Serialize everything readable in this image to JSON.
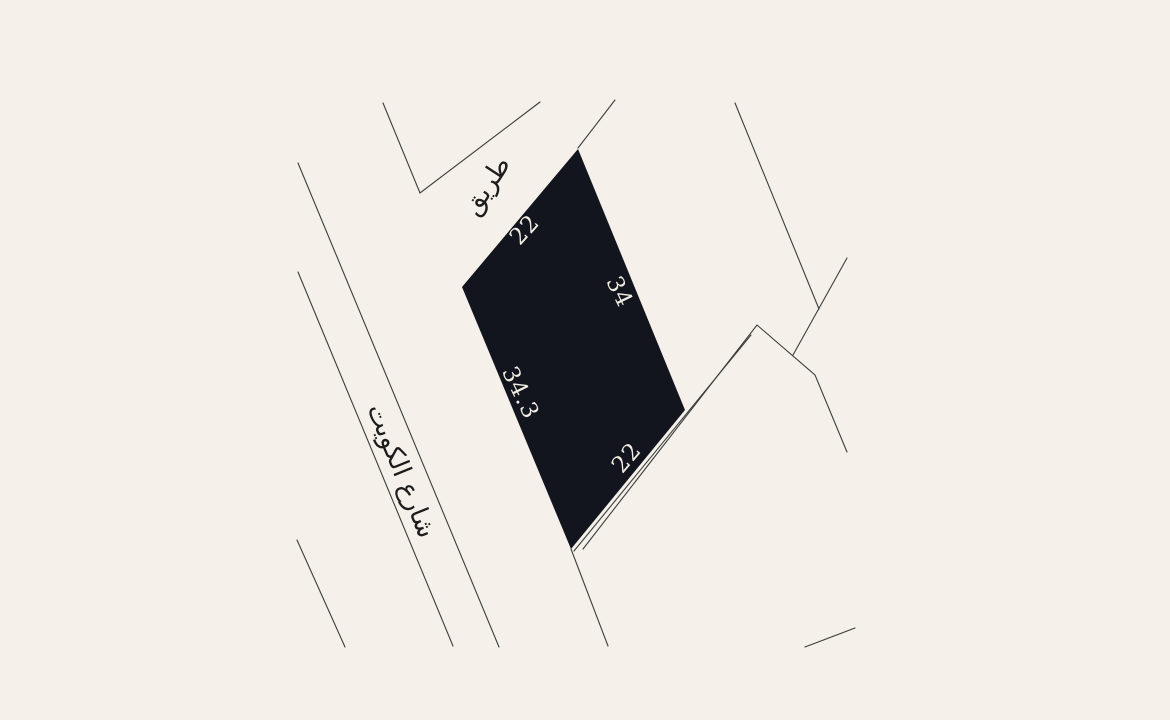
{
  "scene": {
    "colors": {
      "background": "#f5f0e9",
      "parcel_fill": "#12141e",
      "line": "#3d3d3d",
      "dimension_label": "#f2ede3",
      "street_label": "#1c1c1c"
    }
  },
  "parcel": {
    "edge_labels": {
      "northwest": "22",
      "east": "34",
      "southwest": "34.3",
      "southeast": "22"
    }
  },
  "streets": {
    "kuwait_street_label": "شارع الكويت",
    "road_label": "طريق"
  }
}
